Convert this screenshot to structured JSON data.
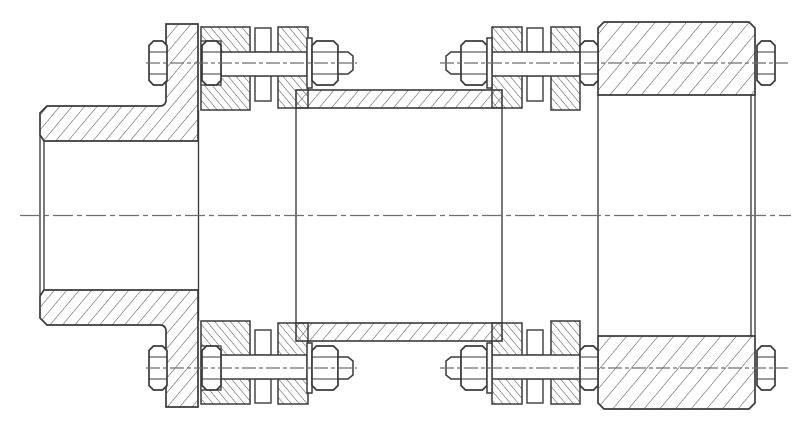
{
  "title": "Flexible disc coupling - sectional assembly drawing",
  "drawing": {
    "kind": "engineering-section-view",
    "units_note": "no dimensions or text are shown in the drawing"
  },
  "colors": {
    "background": "#ffffff",
    "outline": "#3a3a3a",
    "hatch": "#3f3f3f",
    "centerline": "#6f6f6f"
  },
  "strokes": {
    "outline": 1.7,
    "medium": 1.5,
    "thin": 1.35,
    "hatch": 0.95,
    "centerline": 1.25
  },
  "hatch_spacing": {
    "main": 9.5,
    "wide": 12,
    "ring": 6
  },
  "parts": [
    "left-shaft-hub-with-flange",
    "left-flange-adapter-ring",
    "left-disc-pack",
    "center-spacer-tube",
    "right-disc-pack",
    "right-adapter-ring",
    "right-flanged-hub",
    "hex-bolts-with-nuts-and-washers",
    "main-centerline",
    "bolt-axis-centerlines"
  ]
}
